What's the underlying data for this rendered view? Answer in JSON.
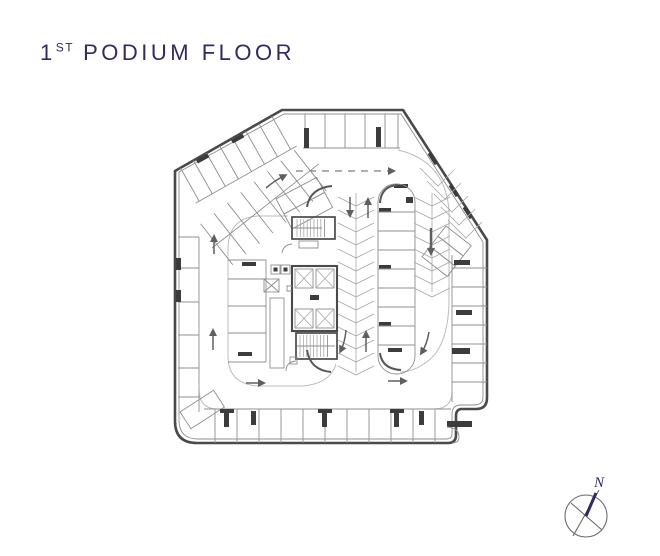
{
  "title": {
    "number": "1",
    "ordinal": "ST",
    "rest": "PODIUM FLOOR"
  },
  "compass": {
    "label": "N"
  },
  "colors": {
    "background": "#ffffff",
    "title": "#322a5e",
    "compass": "#2e2a66",
    "wall": "#4a4a4a",
    "detail": "#8f8f8f",
    "hatch": "#a8a8a8",
    "lane": "#bdbdbd",
    "column": "#3c3c3c",
    "arrow": "#5f5f5f",
    "curb": "#585858"
  }
}
